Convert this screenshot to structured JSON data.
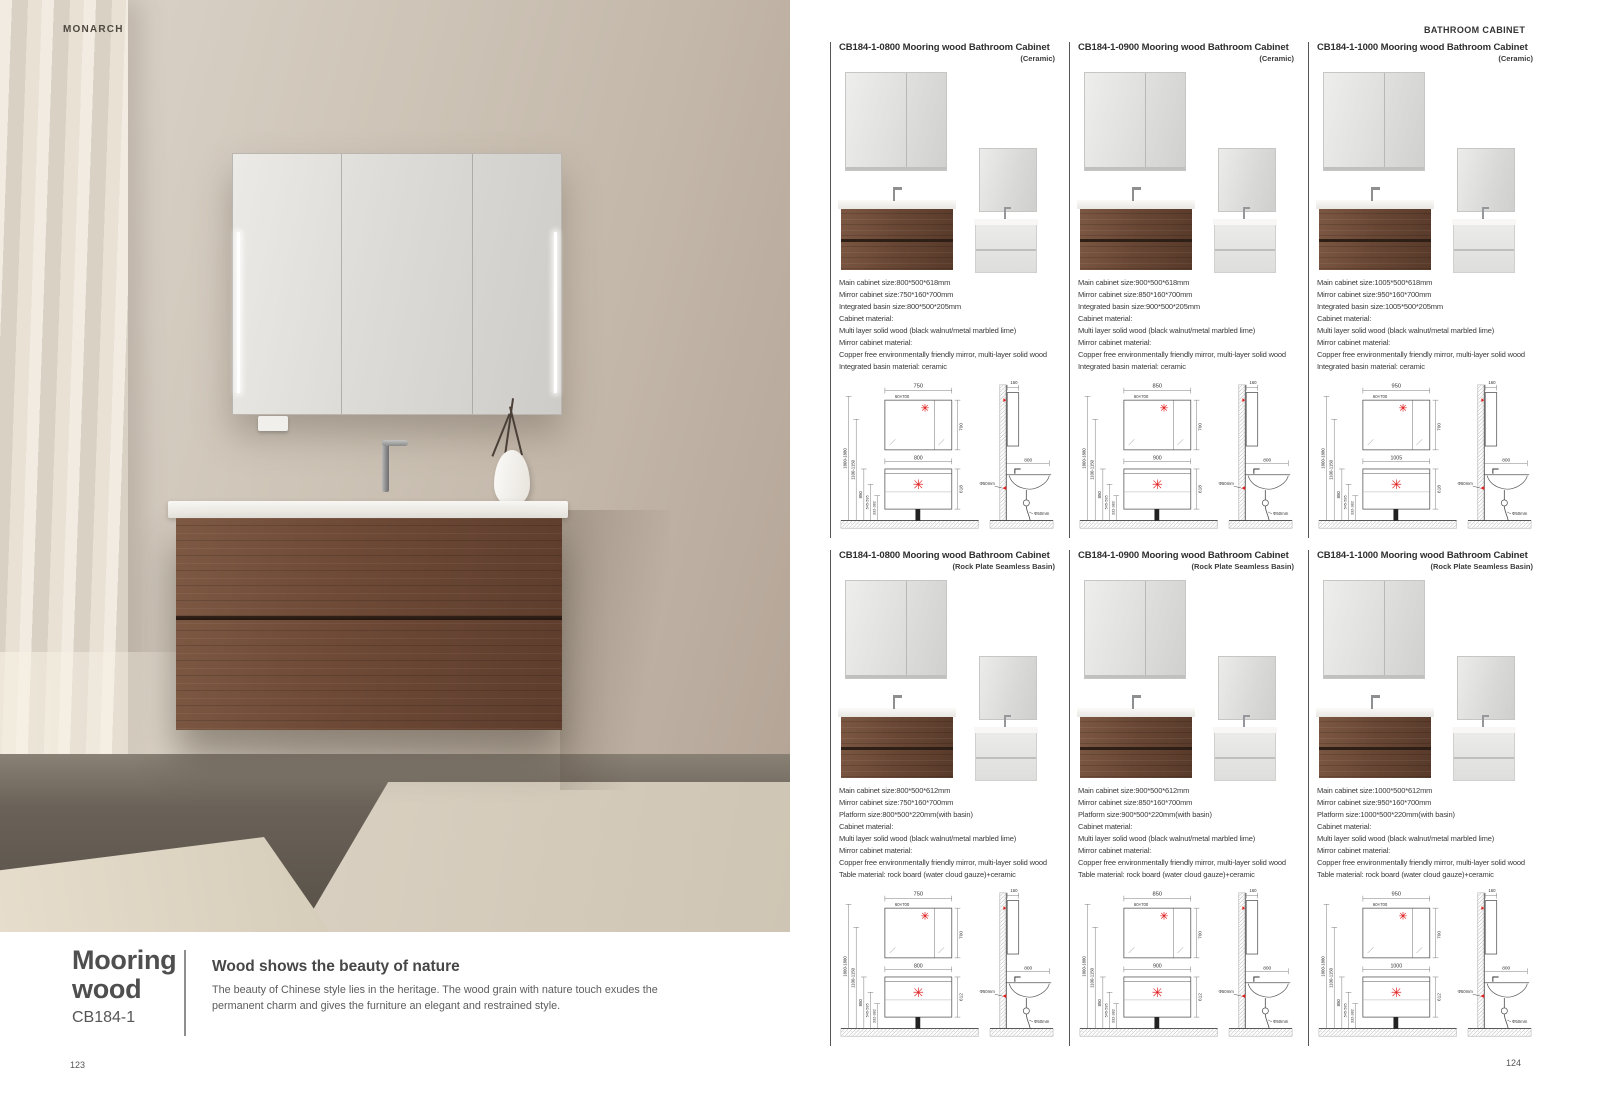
{
  "page": {
    "brand": "MONARCH",
    "header_right": "BATHROOM CABINET",
    "page_left": "123",
    "page_right": "124"
  },
  "left": {
    "series_line1": "Mooring",
    "series_line2": "wood",
    "code": "CB184-1",
    "headline": "Wood shows the beauty of nature",
    "description": "The beauty of Chinese style lies in the heritage. The wood grain with nature touch exudes the permanent charm and gives the furniture an elegant and restrained style."
  },
  "colors": {
    "wood": "#6d4936",
    "accent_red": "#e02020",
    "wall_beige": "#c2b6a8"
  },
  "cards": [
    {
      "title": "CB184-1-0800 Mooring wood Bathroom Cabinet",
      "variant": "(Ceramic)",
      "specs": [
        "Main cabinet size:800*500*618mm",
        "Mirror cabinet size:750*160*700mm",
        "Integrated basin size:800*500*205mm",
        "Cabinet material:",
        "Multi layer solid wood (black walnut/metal marbled lime)",
        "Mirror cabinet material:",
        "Copper free environmentally friendly mirror, multi-layer solid wood",
        "Integrated basin material: ceramic"
      ],
      "drawing": {
        "top_w": "750",
        "strip": "60×700",
        "mirror_h": "700",
        "cab_w": "800",
        "cab_h": "618",
        "wall_h": "1800-1880",
        "mid_h": "1100-1150",
        "h3": "850",
        "h4": "545-595",
        "h5": "332-382",
        "side_top": "160",
        "side_w": "800",
        "drain": "Φ50mm"
      }
    },
    {
      "title": "CB184-1-0900 Mooring wood Bathroom Cabinet",
      "variant": "(Ceramic)",
      "specs": [
        "Main cabinet size:900*500*618mm",
        "Mirror cabinet size:850*160*700mm",
        "Integrated basin size:900*500*205mm",
        "Cabinet material:",
        "Multi layer solid wood (black walnut/metal marbled lime)",
        "Mirror cabinet material:",
        "Copper free environmentally friendly mirror, multi-layer solid wood",
        "Integrated basin material: ceramic"
      ],
      "drawing": {
        "top_w": "850",
        "strip": "60×700",
        "mirror_h": "700",
        "cab_w": "900",
        "cab_h": "618",
        "wall_h": "1800-1880",
        "mid_h": "1100-1150",
        "h3": "850",
        "h4": "545-595",
        "h5": "332-382",
        "side_top": "160",
        "side_w": "800",
        "drain": "Φ50mm"
      }
    },
    {
      "title": "CB184-1-1000 Mooring wood Bathroom Cabinet",
      "variant": "(Ceramic)",
      "specs": [
        "Main cabinet size:1005*500*618mm",
        "Mirror cabinet size:950*160*700mm",
        "Integrated basin size:1005*500*205mm",
        "Cabinet material:",
        "Multi layer solid wood (black walnut/metal marbled lime)",
        "Mirror cabinet material:",
        "Copper free environmentally friendly mirror, multi-layer solid wood",
        "Integrated basin material: ceramic"
      ],
      "drawing": {
        "top_w": "950",
        "strip": "60×700",
        "mirror_h": "700",
        "cab_w": "1005",
        "cab_h": "618",
        "wall_h": "1800-1880",
        "mid_h": "1100-1150",
        "h3": "850",
        "h4": "545-595",
        "h5": "332-382",
        "side_top": "160",
        "side_w": "800",
        "drain": "Φ50mm"
      }
    },
    {
      "title": "CB184-1-0800 Mooring wood Bathroom Cabinet",
      "variant": "(Rock Plate Seamless Basin)",
      "specs": [
        "Main cabinet size:800*500*612mm",
        "Mirror cabinet size:750*160*700mm",
        "Platform size:800*500*220mm(with basin)",
        "Cabinet material:",
        "Multi layer solid wood (black walnut/metal marbled lime)",
        "Mirror cabinet material:",
        "Copper free environmentally friendly mirror, multi-layer solid wood",
        "Table material: rock board (water cloud gauze)+ceramic"
      ],
      "drawing": {
        "top_w": "750",
        "strip": "60×700",
        "mirror_h": "700",
        "cab_w": "800",
        "cab_h": "612",
        "wall_h": "1800-1880",
        "mid_h": "1100-1150",
        "h3": "850",
        "h4": "545-595",
        "h5": "332-382",
        "side_top": "160",
        "side_w": "800",
        "drain": "Φ50mm"
      }
    },
    {
      "title": "CB184-1-0900 Mooring wood Bathroom Cabinet",
      "variant": "(Rock Plate Seamless Basin)",
      "specs": [
        "Main cabinet size:900*500*612mm",
        "Mirror cabinet size:850*160*700mm",
        "Platform size:900*500*220mm(with basin)",
        "Cabinet material:",
        "Multi layer solid wood (black walnut/metal marbled lime)",
        "Mirror cabinet material:",
        "Copper free environmentally friendly mirror, multi-layer solid wood",
        "Table material: rock board (water cloud gauze)+ceramic"
      ],
      "drawing": {
        "top_w": "850",
        "strip": "60×700",
        "mirror_h": "700",
        "cab_w": "900",
        "cab_h": "612",
        "wall_h": "1800-1880",
        "mid_h": "1100-1150",
        "h3": "850",
        "h4": "545-595",
        "h5": "332-382",
        "side_top": "160",
        "side_w": "800",
        "drain": "Φ50mm"
      }
    },
    {
      "title": "CB184-1-1000 Mooring wood Bathroom Cabinet",
      "variant": "(Rock Plate Seamless Basin)",
      "specs": [
        "Main cabinet size:1000*500*612mm",
        "Mirror cabinet size:950*160*700mm",
        "Platform size:1000*500*220mm(with basin)",
        "Cabinet material:",
        "Multi layer solid wood (black walnut/metal marbled lime)",
        "Mirror cabinet material:",
        "Copper free environmentally friendly mirror, multi-layer solid wood",
        "Table material: rock board (water cloud gauze)+ceramic"
      ],
      "drawing": {
        "top_w": "950",
        "strip": "60×700",
        "mirror_h": "700",
        "cab_w": "1000",
        "cab_h": "612",
        "wall_h": "1800-1880",
        "mid_h": "1100-1150",
        "h3": "850",
        "h4": "545-595",
        "h5": "332-382",
        "side_top": "160",
        "side_w": "800",
        "drain": "Φ50mm"
      }
    }
  ]
}
